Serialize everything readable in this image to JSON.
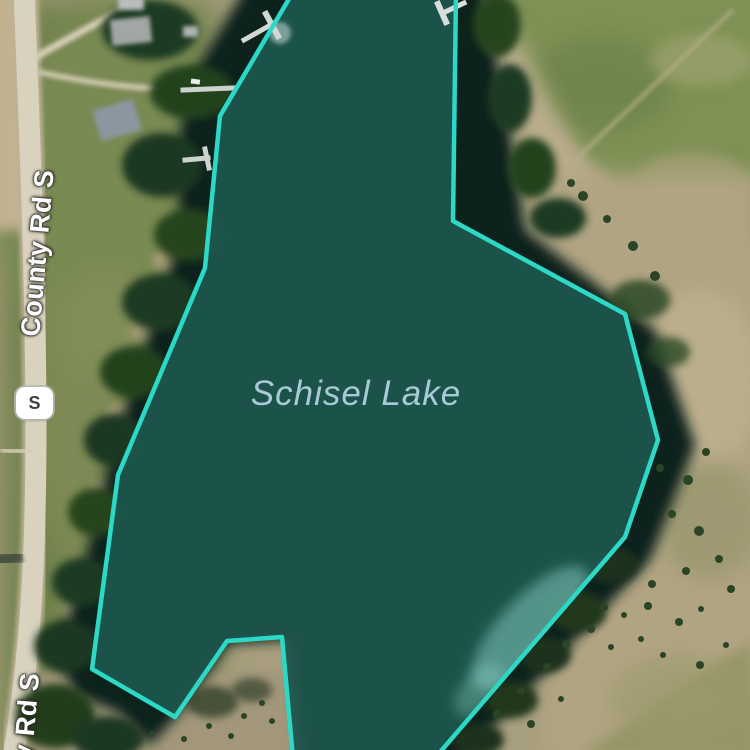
{
  "map": {
    "labels": {
      "lake": "Schisel Lake",
      "road": "County Rd S",
      "road_partial": "y Rd S",
      "shield": "S"
    },
    "colors": {
      "selection_fill": "#1d564c",
      "selection_stroke": "#2bd9c6",
      "deep_water": "#0c211c",
      "lake_label_text": "#a8cad8",
      "road_label_text": "#fdfdfd",
      "shield_background": "#ffffff",
      "shield_text": "#3f3f3f"
    }
  }
}
